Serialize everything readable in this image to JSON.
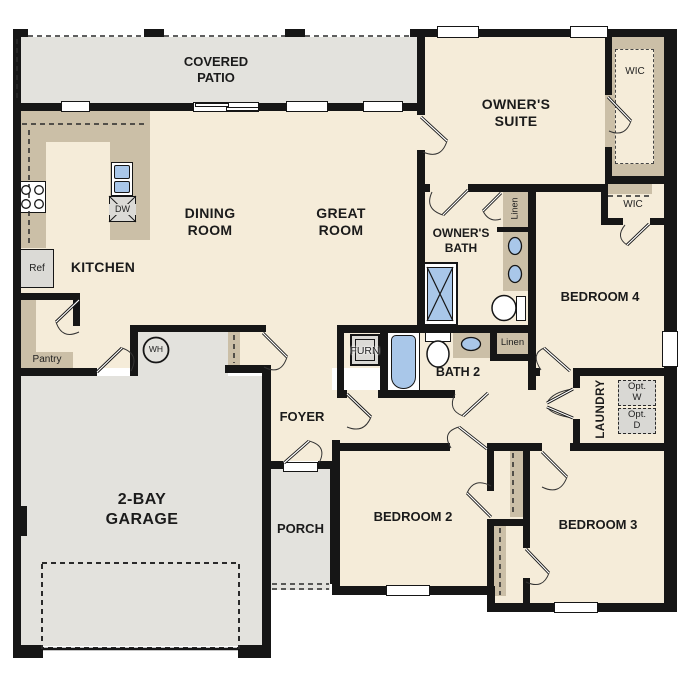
{
  "plan_title": "Single-story floor plan",
  "colors": {
    "wall": "#161616",
    "floor_interior": "#f5ecd9",
    "floor_exterior": "#e3e2dd",
    "casework_tan": "#cbbfa7",
    "fixture_blue": "#a9c7e9",
    "fixture_gray": "#dbdad6"
  },
  "rooms": {
    "covered_patio": "COVERED\nPATIO",
    "owners_suite": "OWNER'S\nSUITE",
    "dining_room": "DINING\nROOM",
    "great_room": "GREAT\nROOM",
    "kitchen": "KITCHEN",
    "owners_bath": "OWNER'S\nBATH",
    "bedroom4": "BEDROOM 4",
    "bath2": "BATH 2",
    "laundry": "LAUNDRY",
    "foyer": "FOYER",
    "garage": "2-BAY\nGARAGE",
    "porch": "PORCH",
    "bedroom2": "BEDROOM 2",
    "bedroom3": "BEDROOM 3"
  },
  "closets": {
    "wic_owners": "WIC",
    "wic_bedroom4": "WIC",
    "pantry": "Pantry",
    "linen_owners": "Linen",
    "linen_hall": "Linen"
  },
  "fixtures": {
    "refrigerator": "Ref",
    "dishwasher": "DW",
    "water_heater": "WH",
    "furnace": "FURN",
    "opt_washer": "Opt.\nW",
    "opt_dryer": "Opt.\nD"
  }
}
